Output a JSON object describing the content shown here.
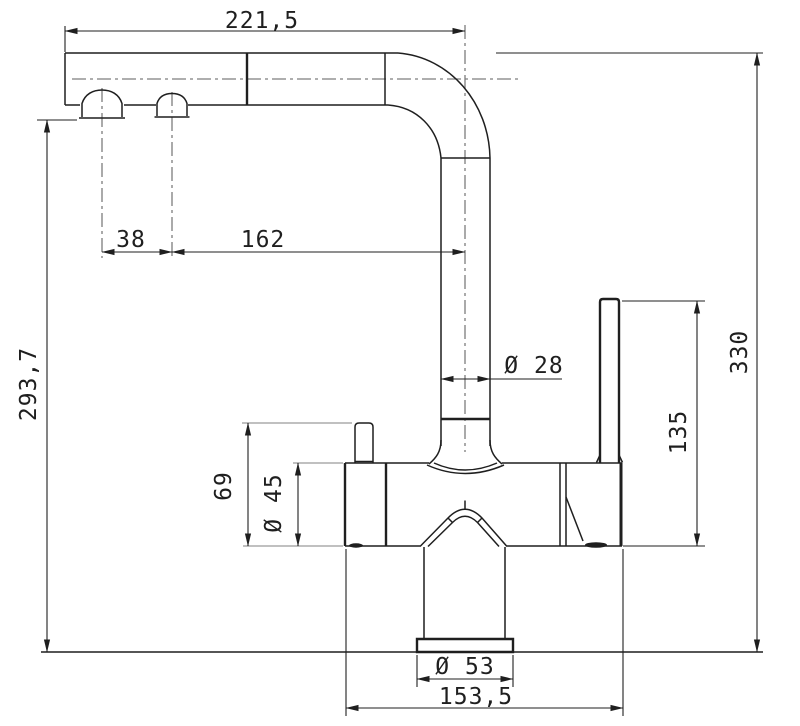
{
  "meta": {
    "drawing_type": "faucet-technical-drawing",
    "background": "#ffffff",
    "line_color": "#1f1f1f",
    "centerline_color": "#7d7d7d"
  },
  "dimensions": {
    "spout_length": "221,5",
    "nozzle_spacing": "38",
    "horizontal_reach": "162",
    "outlet_height": "293,7",
    "overall_height": "330",
    "lever_height": "135",
    "pipe_diameter": "Ø 28",
    "knob_height": "69",
    "body_diameter": "Ø 45",
    "base_diameter": "Ø 53",
    "body_length": "153,5"
  }
}
